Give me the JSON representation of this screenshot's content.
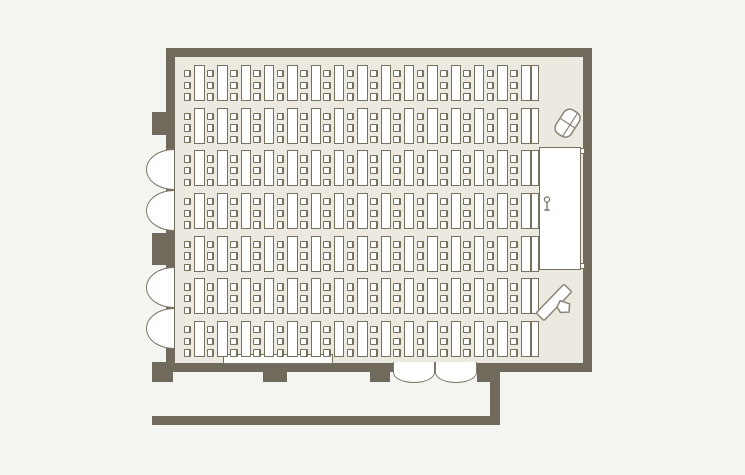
{
  "colors": {
    "wall": "#6F6A5B",
    "floor": "#ECEAE0",
    "background": "#F4F4F1",
    "furniture_stroke": "#76715F",
    "furniture_fill": "#FFFFFF",
    "icon_stroke": "#8A8476"
  },
  "seating": {
    "rows": 7,
    "tables_per_row": 15,
    "chairs_per_table": 3,
    "trailing_tables_per_row": 1,
    "total_chairs": 315,
    "orientation": "chairs-left-of-tables-facing-stage"
  },
  "stage": {
    "present": true,
    "steps": 2,
    "has_microphone": true
  },
  "doors": {
    "left_wall_door_leaves": 4,
    "bottom_wall_door_leaves": 2
  },
  "fixtures": {
    "wall_pillars_left": 2,
    "wall_pillars_bottom": 3,
    "corridor_walls": 2,
    "wall_tables": 1
  },
  "icons": [
    "projector-icon",
    "projection-screen-icon",
    "microphone-icon"
  ]
}
